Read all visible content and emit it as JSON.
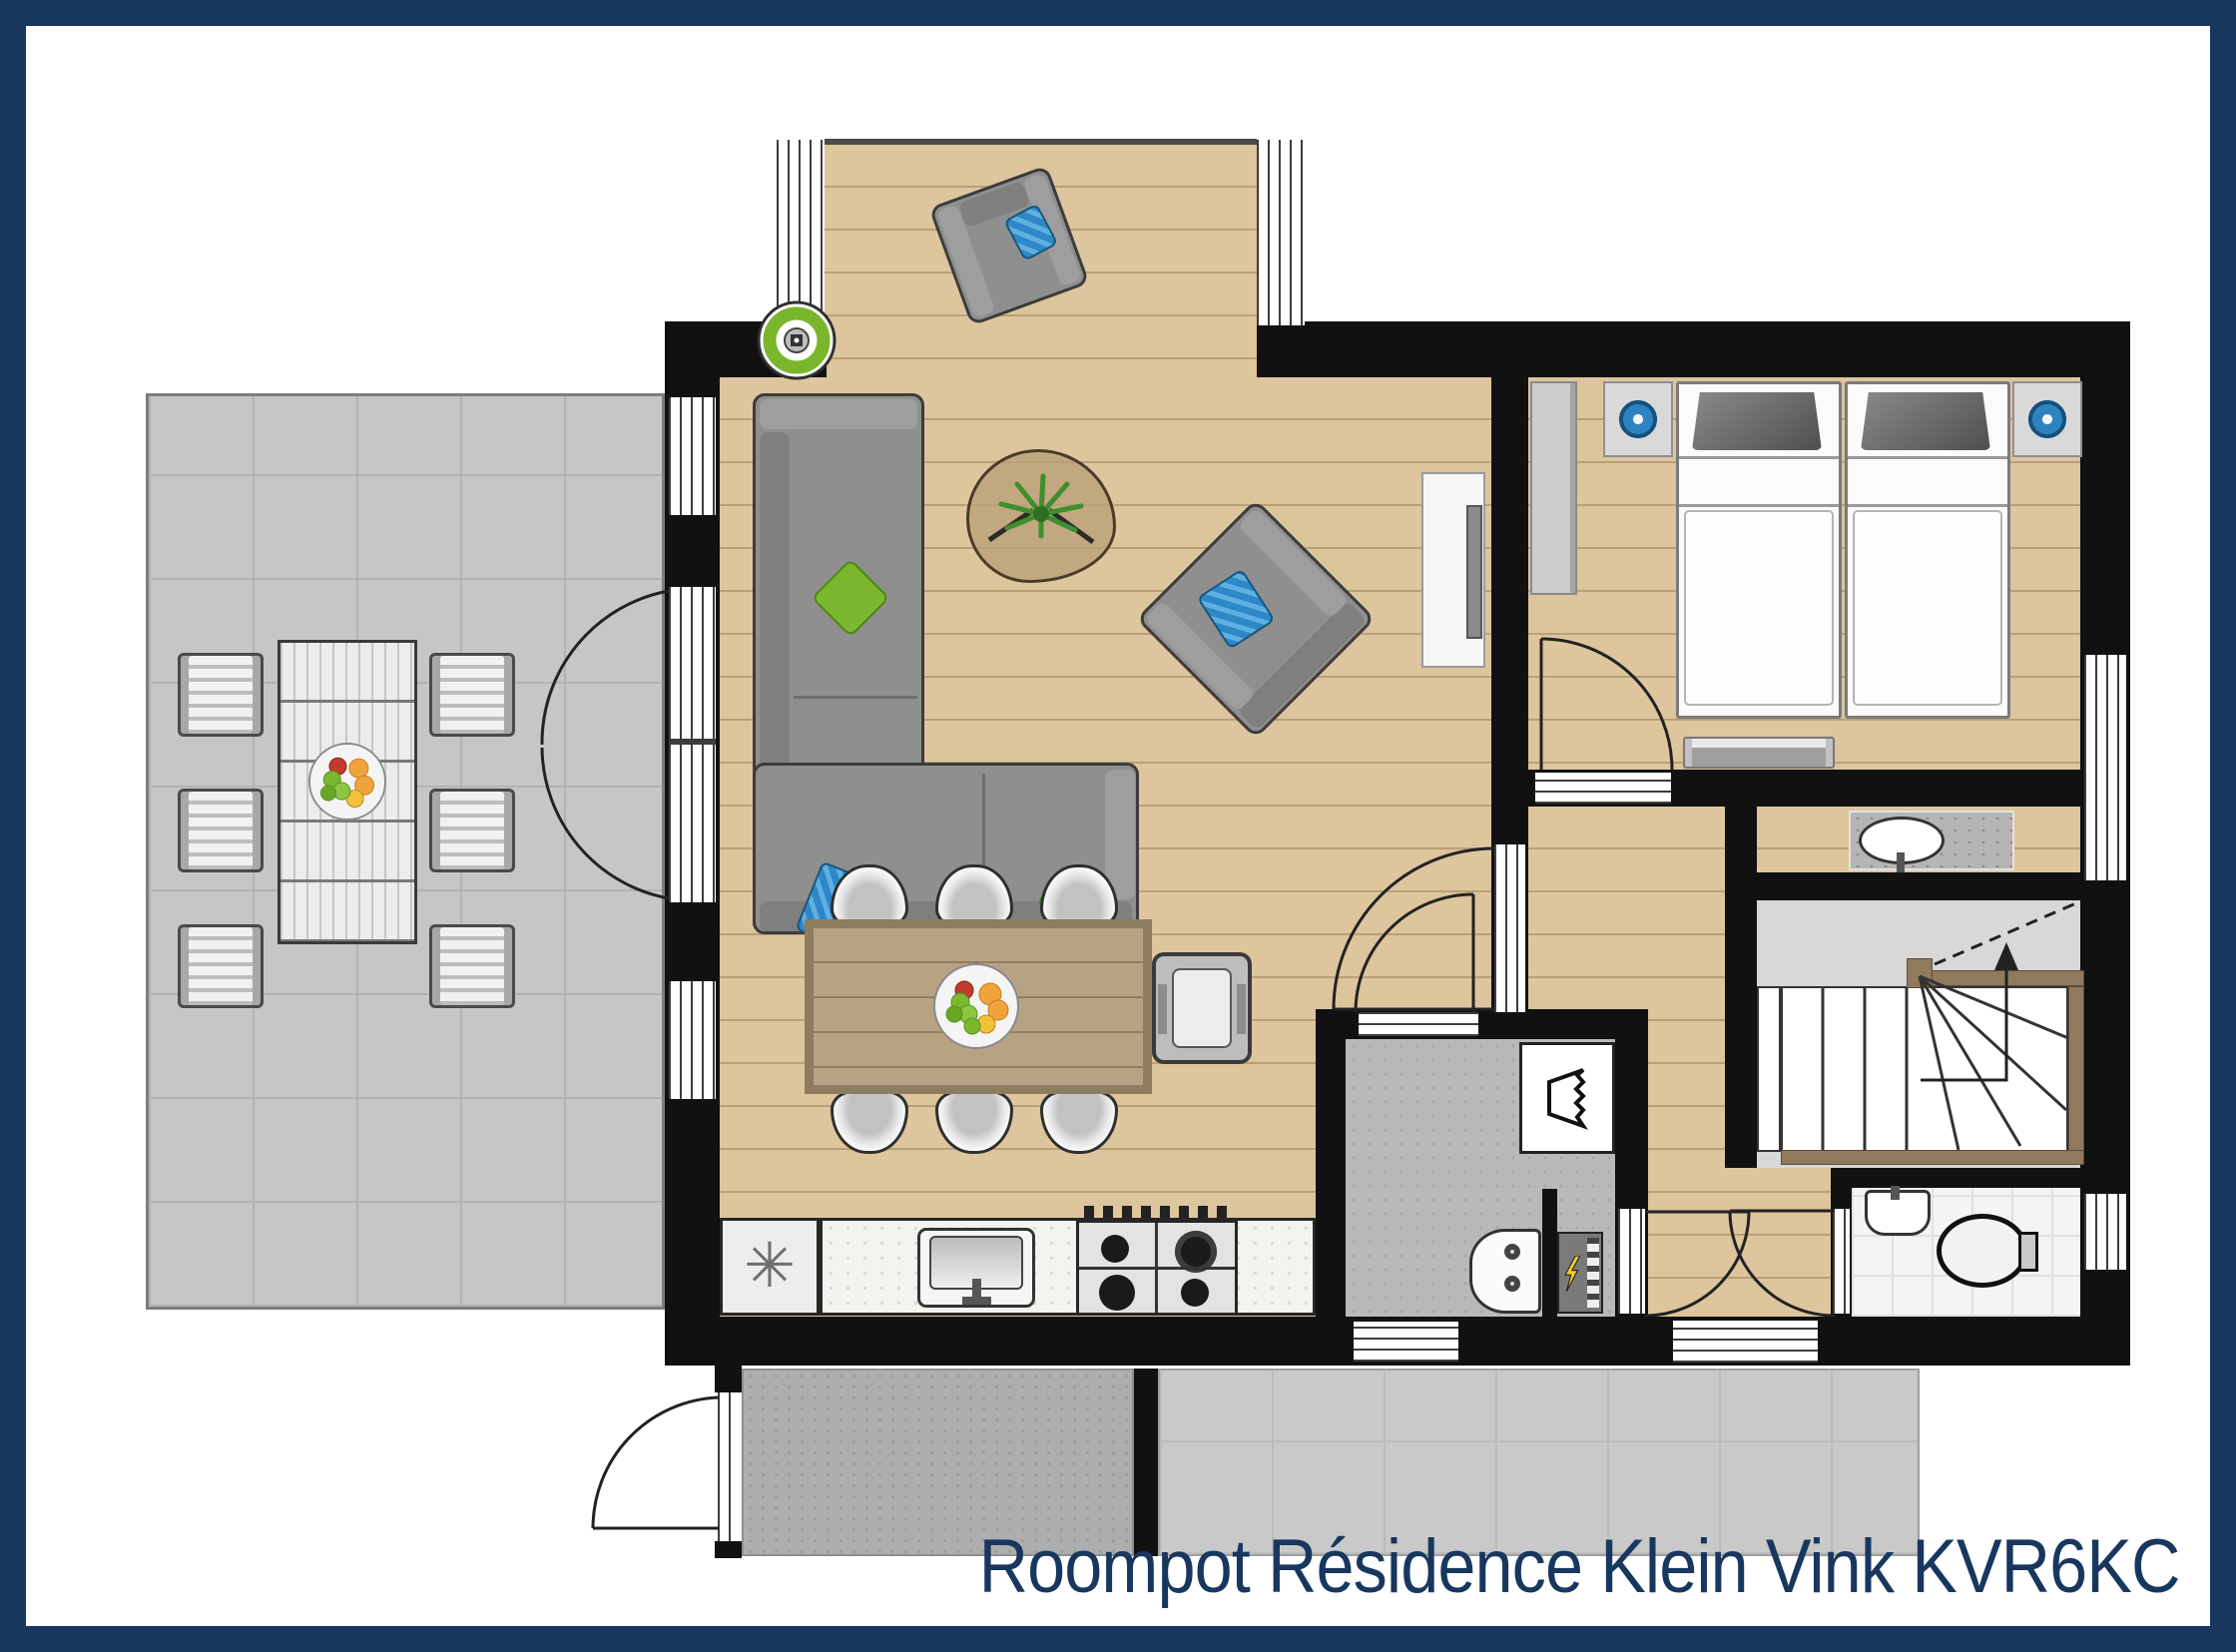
{
  "title": {
    "text": "Roompot Résidence Klein Vink KVR6KC"
  },
  "symbols": {
    "freezer": "✳"
  },
  "palette": {
    "frame": "#17375f",
    "title_color": "#17375f",
    "paper": "#ffffff",
    "wall": "#111111",
    "wood": "#ddc59d",
    "terrace": "#c6c6c6",
    "porch": "#aeaeae",
    "concrete": "#b9b9b9",
    "stairs_bg": "#d8d8d8",
    "stair_wood": "#8f7a5d",
    "sofa": "#8f8f8f",
    "sofa_dark": "#3c3c3c",
    "green": "#7cb82f",
    "blue": "#2e87c8",
    "lamp_blue": "#2d83c0",
    "table_wood": "#b7a284",
    "counter": "#f3f3ef",
    "marble": "#b5b5b5",
    "bolt": "#f2d023"
  }
}
